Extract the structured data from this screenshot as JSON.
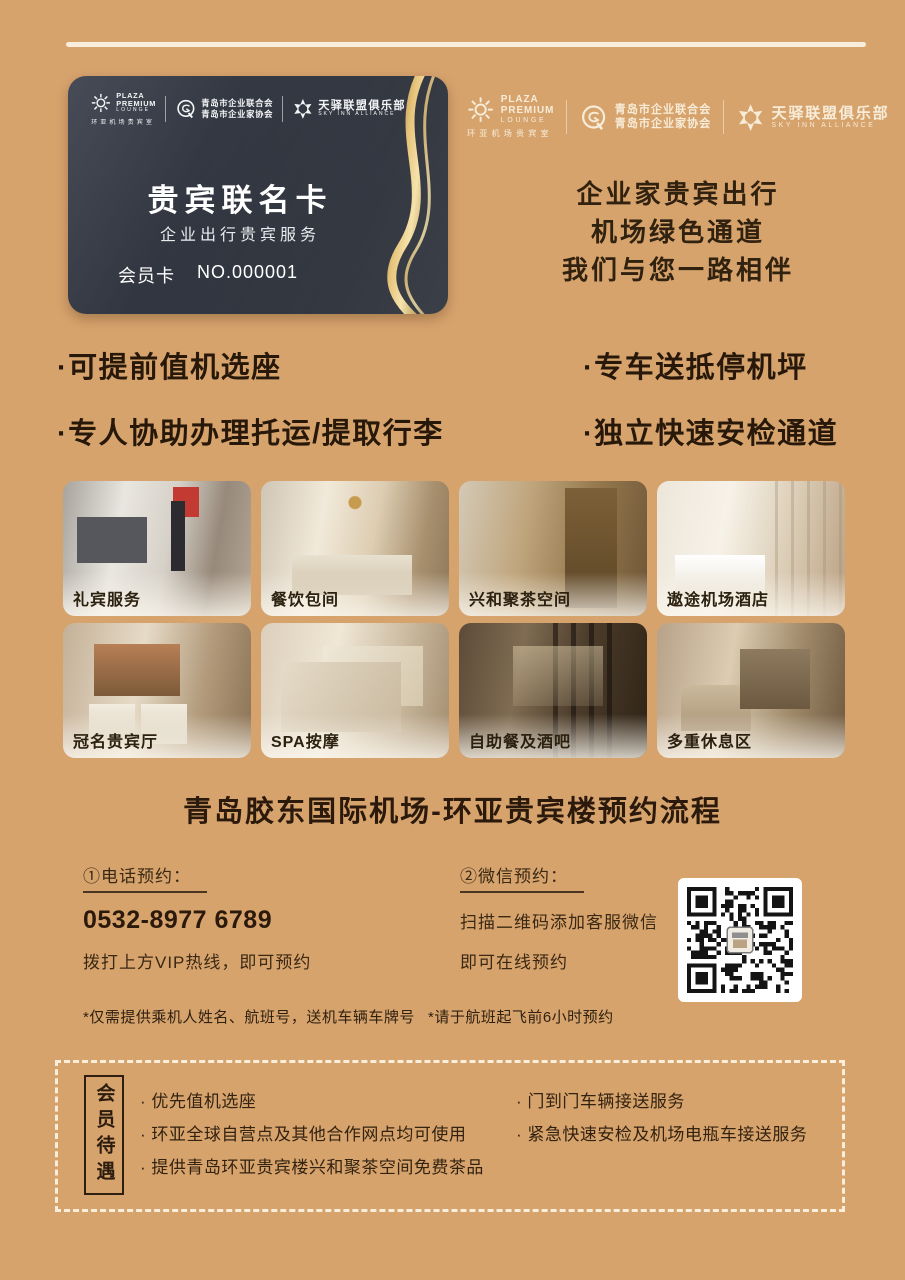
{
  "colors": {
    "background": "#d7a36d",
    "card": "#31353f",
    "gold": "#e6c37a",
    "cream": "#f8eedb",
    "text_dark": "#2b1a0c"
  },
  "logos": {
    "plaza": {
      "l1": "PLAZA",
      "l2": "PREMIUM",
      "l3": "LOUNGE",
      "sub": "环亚机场贵宾室"
    },
    "qingdao": {
      "l1": "青岛市企业联合会",
      "l2": "青岛市企业家协会"
    },
    "sky": {
      "name": "天驿联盟俱乐部",
      "sub": "SKY INN ALLIANCE"
    }
  },
  "card": {
    "title": "贵宾联名卡",
    "subtitle": "企业出行贵宾服务",
    "member_label": "会员卡",
    "member_no": "NO.000001"
  },
  "header_right": {
    "slogans": [
      "企业家贵宾出行",
      "机场绿色通道",
      "我们与您一路相伴"
    ]
  },
  "features": {
    "left": [
      "·可提前值机选座",
      "·专人协助办理托运/提取行李"
    ],
    "right": [
      "·专车送抵停机坪",
      "·独立快速安检通道"
    ]
  },
  "gallery": [
    {
      "caption": "礼宾服务"
    },
    {
      "caption": "餐饮包间"
    },
    {
      "caption": "兴和聚茶空间"
    },
    {
      "caption": "遨途机场酒店"
    },
    {
      "caption": "冠名贵宾厅"
    },
    {
      "caption": "SPA按摩"
    },
    {
      "caption": "自助餐及酒吧"
    },
    {
      "caption": "多重休息区"
    }
  ],
  "booking": {
    "title": "青岛胶东国际机场-环亚贵宾楼预约流程",
    "phone": {
      "label": "①电话预约：",
      "number": "0532-8977 6789",
      "desc": "拨打上方VIP热线，即可预约"
    },
    "wechat": {
      "label": "②微信预约：",
      "line1": "扫描二维码添加客服微信",
      "line2": "即可在线预约"
    },
    "notes": [
      "*仅需提供乘机人姓名、航班号，送机车辆车牌号",
      "*请于航班起飞前6小时预约"
    ]
  },
  "benefits": {
    "label": "会员待遇",
    "left": [
      "· 优先值机选座",
      "· 环亚全球自营点及其他合作网点均可使用",
      "· 提供青岛环亚贵宾楼兴和聚茶空间免费茶品"
    ],
    "right": [
      "· 门到门车辆接送服务",
      "· 紧急快速安检及机场电瓶车接送服务"
    ]
  }
}
